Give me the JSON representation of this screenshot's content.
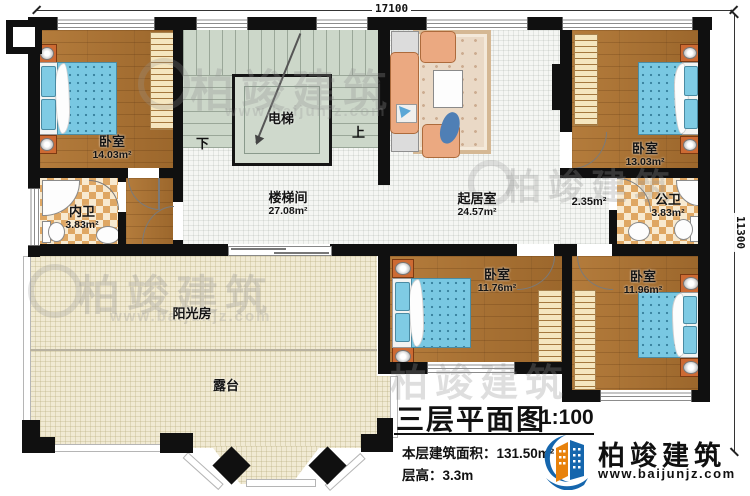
{
  "dims": {
    "top": "17100",
    "right": "11300"
  },
  "rooms": {
    "bedroom_tl": {
      "name": "卧室",
      "area": "14.03m²"
    },
    "inner_bath": {
      "name": "内卫",
      "area": "3.83m²"
    },
    "stair_hall": {
      "name": "楼梯间",
      "area": "27.08m²"
    },
    "elevator": {
      "name": "电梯"
    },
    "living": {
      "name": "起居室",
      "area": "24.57m²"
    },
    "bedroom_tr": {
      "name": "卧室",
      "area": "13.03m²"
    },
    "corridor": {
      "area": "2.35m²"
    },
    "public_bath": {
      "name": "公卫",
      "area": "3.83m²"
    },
    "bedroom_bm": {
      "name": "卧室",
      "area": "11.76m²"
    },
    "bedroom_br": {
      "name": "卧室",
      "area": "11.96m²"
    },
    "sunroom": {
      "name": "阳光房"
    },
    "terrace": {
      "name": "露台"
    }
  },
  "stairs": {
    "down": "下",
    "up": "上"
  },
  "titleblock": {
    "title": "三层平面图",
    "scale": "1:100",
    "floor_area": "本层建筑面积：131.50m²",
    "floor_height": "层高：3.3m"
  },
  "brand": {
    "name": "柏竣建筑",
    "url": "www.baijunjz.com"
  },
  "watermark": {
    "text": "柏竣建筑",
    "url": "www.baijunjz.com"
  }
}
